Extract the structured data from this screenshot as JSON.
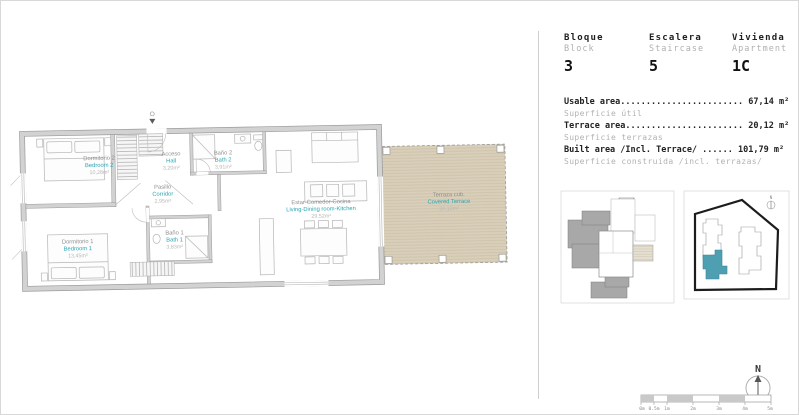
{
  "colors": {
    "teal": "#2ba6b4",
    "wall_grey": "#d2d2d2",
    "terrace_tan": "#d9cfba",
    "site_unit_teal": "#4f9fb2"
  },
  "plan": {
    "rooms": [
      {
        "name_es": "Dormitorio 2",
        "name_en": "Bedroom 2",
        "area": "10,28m²"
      },
      {
        "name_es": "Acceso",
        "name_en": "Hall",
        "area": "3,20m²"
      },
      {
        "name_es": "Baño 2",
        "name_en": "Bath 2",
        "area": "3,91m²"
      },
      {
        "name_es": "Pasillo",
        "name_en": "Corridor",
        "area": "2,95m²"
      },
      {
        "name_es": "Dormitorio 1",
        "name_en": "Bedroom 1",
        "area": "13,45m²"
      },
      {
        "name_es": "Baño 1",
        "name_en": "Bath 1",
        "area": "3,83m²"
      },
      {
        "name_es": "Estar-Comedor-Cocina",
        "name_en": "Living-Dining room-Kitchen",
        "area": "29,52m²"
      },
      {
        "name_es": "Terraza cub.",
        "name_en": "Covered Terrace",
        "area": "20,12m²"
      }
    ]
  },
  "panel": {
    "unit_fields": [
      {
        "label_es": "Bloque",
        "label_en": "Block",
        "value": "3"
      },
      {
        "label_es": "Escalera",
        "label_en": "Staircase",
        "value": "5"
      },
      {
        "label_es": "Vivienda",
        "label_en": "Apartment",
        "value": "1C"
      }
    ],
    "areas": [
      {
        "label": "Usable area",
        "dots": "........................",
        "value": " 67,14 m²",
        "sub": "Superficie útil"
      },
      {
        "label": "Terrace area",
        "dots": ".......................",
        "value": " 20,12 m²",
        "sub": "Superficie terrazas"
      },
      {
        "label": "Built area /Incl. Terrace/ ",
        "dots": "......",
        "value": " 101,79 m²",
        "sub": "Superficie construida /incl. terrazas/"
      }
    ]
  },
  "compass": {
    "north": "N"
  },
  "site_plan": {
    "north": "N"
  },
  "scale_bar": {
    "labels": [
      "0m",
      "0.5m",
      "1m",
      "2m",
      "3m",
      "4m",
      "5m"
    ]
  }
}
